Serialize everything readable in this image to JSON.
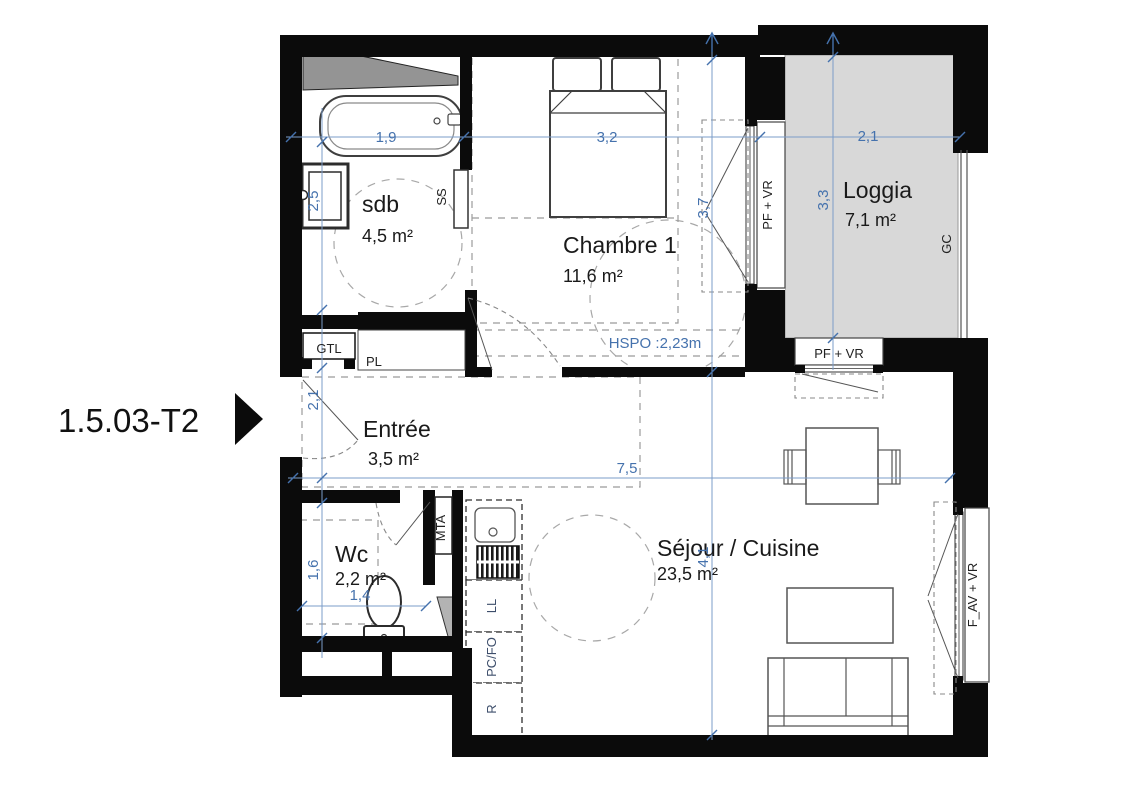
{
  "title": "1.5.03-T2",
  "rooms": [
    {
      "name": "sdb",
      "area": "4,5 m²"
    },
    {
      "name": "Chambre 1",
      "area": "11,6 m²"
    },
    {
      "name": "Loggia",
      "area": "7,1 m²"
    },
    {
      "name": "Entrée",
      "area": "3,5 m²"
    },
    {
      "name": "Wc",
      "area": "2,2 m²"
    },
    {
      "name": "Séjour / Cuisine",
      "area": "23,5 m²"
    }
  ],
  "dimensions": {
    "sdb_width": "1,9",
    "chambre_width": "3,2",
    "loggia_width": "2,1",
    "bath_wall": "2,5",
    "entree_wall": "2,1",
    "wc_wall": "1,6",
    "wc_width": "1,4",
    "chambre_depth": "3,7",
    "loggia_depth": "3,3",
    "sejour_depth": "4,1",
    "sejour_width": "7,5",
    "hspo_note": "HSPO :2,23m"
  },
  "labels": {
    "gtl": "GTL",
    "pl": "PL",
    "ss": "SS",
    "mta": "MTA",
    "ll": "LL",
    "pc_fo": "PC/FO",
    "fridge": "R",
    "window_chambre": "PF + VR",
    "window_loggia": "PF + VR",
    "window_sejour": "F_AV + VR",
    "guardrail": "GC"
  },
  "colors": {
    "wall": "#0b0b0b",
    "loggia_fill": "#d8d8d8",
    "dimension_blue": "#4572ad",
    "kitchen_label": "#3d4e6b"
  }
}
